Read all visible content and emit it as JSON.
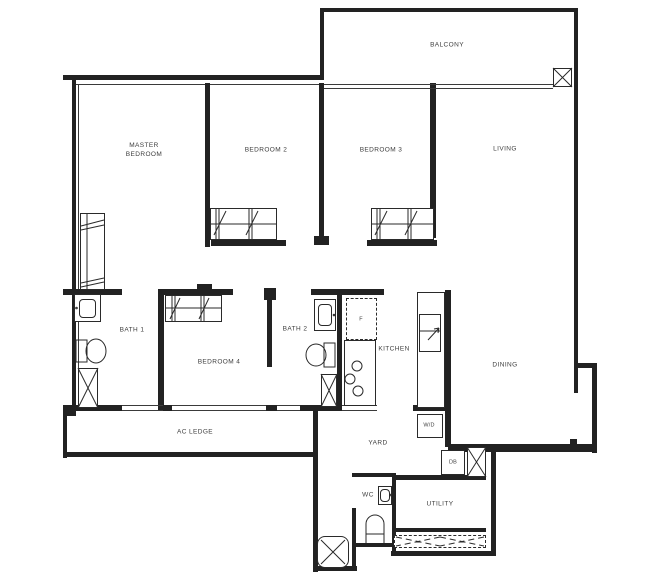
{
  "plan": {
    "title": "apartment-floor-plan",
    "rooms": {
      "balcony": {
        "label": "BALCONY"
      },
      "master_bedroom": {
        "label": "MASTER\nBEDROOM"
      },
      "bedroom2": {
        "label": "BEDROOM 2"
      },
      "bedroom3": {
        "label": "BEDROOM 3"
      },
      "living": {
        "label": "LIVING"
      },
      "bath1": {
        "label": "BATH 1"
      },
      "bedroom4": {
        "label": "BEDROOM 4"
      },
      "bath2": {
        "label": "BATH 2"
      },
      "kitchen": {
        "label": "KITCHEN"
      },
      "dining": {
        "label": "DINING"
      },
      "ac_ledge": {
        "label": "AC LEDGE"
      },
      "yard": {
        "label": "YARD"
      },
      "wc": {
        "label": "WC"
      },
      "utility": {
        "label": "UTILITY"
      }
    },
    "fixtures": {
      "fridge": {
        "label": "F"
      },
      "washer_dryer": {
        "label": "W/D"
      },
      "distribution_board": {
        "label": "DB"
      }
    },
    "colors": {
      "line": "#222222",
      "text": "#3d3d3d",
      "background": "#ffffff"
    }
  }
}
